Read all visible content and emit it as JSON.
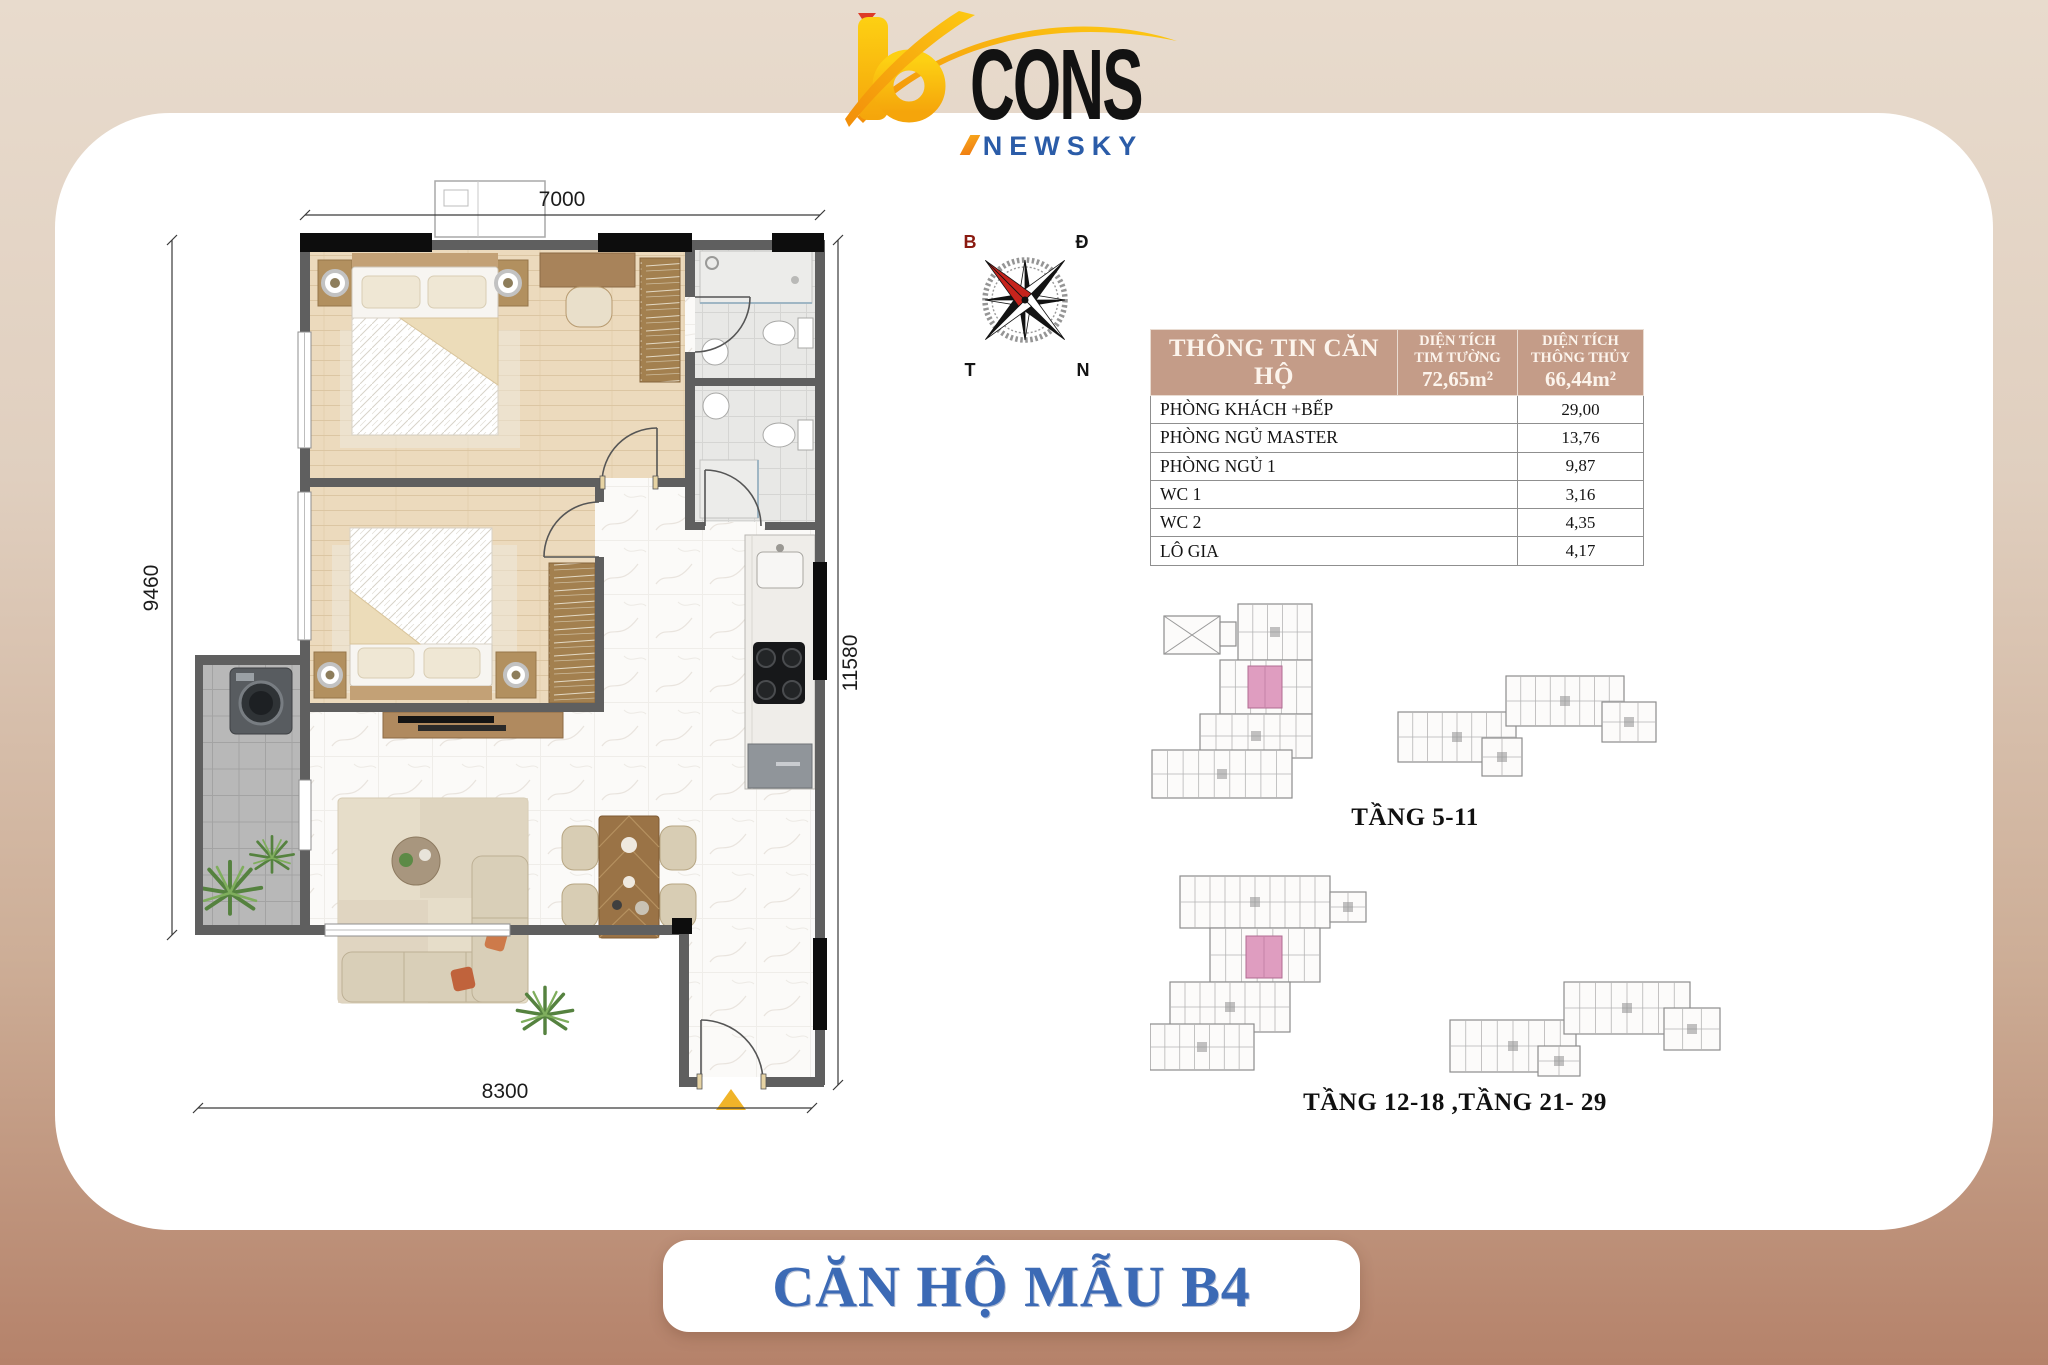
{
  "logo": {
    "b": "b",
    "cons": "CONS",
    "sub": "NEWSKY"
  },
  "compass": {
    "top_left": "B",
    "top_right": "Đ",
    "bottom_left": "T",
    "bottom_right": "N"
  },
  "info_table": {
    "columns": [
      {
        "label": "THÔNG TIN CĂN HỘ"
      },
      {
        "label": "DIỆN TÍCH\nTIM TƯỜNG",
        "value": "72,65m²"
      },
      {
        "label": "DIỆN TÍCH\nTHÔNG THỦY",
        "value": "66,44m²"
      }
    ],
    "rows": [
      {
        "label": "PHÒNG KHÁCH +BẾP",
        "value": "29,00"
      },
      {
        "label": "PHÒNG NGỦ MASTER",
        "value": "13,76"
      },
      {
        "label": "PHÒNG NGỦ 1",
        "value": "9,87"
      },
      {
        "label": "WC 1",
        "value": "3,16"
      },
      {
        "label": "WC 2",
        "value": "4,35"
      },
      {
        "label": "LÔ GIA",
        "value": "4,17"
      }
    ]
  },
  "floor_plan": {
    "dim_top": "7000",
    "dim_left": "9460",
    "dim_right": "11580",
    "dim_bottom": "8300"
  },
  "key_plans": [
    {
      "label": "TẦNG 5-11"
    },
    {
      "label": "TẦNG 12-18 ,TẦNG 21- 29"
    }
  ],
  "banner_title": "CĂN HỘ MẪU B4",
  "colors": {
    "accent_blue": "#3c6ab5",
    "table_header_bg": "#c49c88",
    "logo_yellow": "#f9bd0d",
    "logo_orange": "#f2920c",
    "logo_blue": "#2b5ca8",
    "highlight_pink": "#df9dc0",
    "compass_red": "#c6231c",
    "entrance_marker": "#f0b429",
    "bg_top": "#e8dbcd",
    "bg_bottom": "#b5826a"
  }
}
